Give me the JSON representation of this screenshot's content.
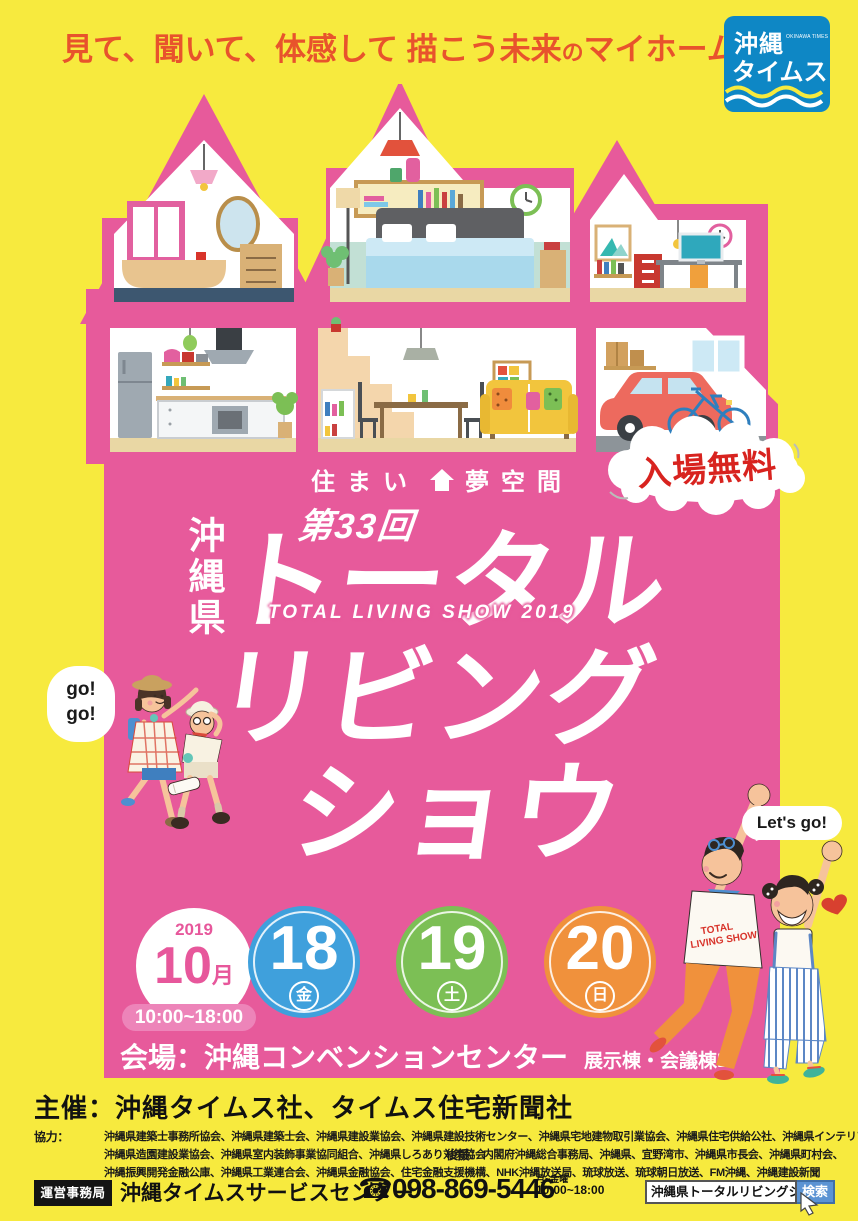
{
  "poster": {
    "headline": {
      "part1": "見て、聞いて、体感して 描こう未来",
      "small": "の",
      "part2": "マイホーム"
    },
    "logo": {
      "name1": "沖縄",
      "name2": "タイムス",
      "sub": "OKINAWA TIMES"
    },
    "tagline": {
      "left": "住まい",
      "right": "夢空間"
    },
    "edition": "第33回",
    "prefecture": "沖縄県",
    "title": {
      "line1": "トータル",
      "line2": "リビング",
      "line3": "ショウ",
      "subtitle": "TOTAL LIVING SHOW 2019"
    },
    "free_admission": "入場無料",
    "bubbles": {
      "go_line1": "go!",
      "go_line2": "go!",
      "lets_go": "Let's go!",
      "tshirt_line1": "TOTAL",
      "tshirt_line2": "LIVING SHOW"
    },
    "schedule": {
      "year": "2019",
      "month": "10",
      "month_unit": "月",
      "hours": "10:00~18:00",
      "days": [
        {
          "num": "18",
          "weekday": "金",
          "color": "#3FA0DC"
        },
        {
          "num": "19",
          "weekday": "土",
          "color": "#7CBF55"
        },
        {
          "num": "20",
          "weekday": "日",
          "color": "#F0913C"
        }
      ],
      "venue": "会場：沖縄コンベンションセンター",
      "venue_note": "展示棟・会議棟B"
    },
    "footer": {
      "organizer": "主催：沖縄タイムス社、タイムス住宅新聞社",
      "cooperation_label": "協力：",
      "cooperation_line1": "沖縄県建築士事務所協会、沖縄県建築士会、沖縄県建設業協会、沖縄県建設技術センター、沖縄県宅地建物取引業協会、沖縄県住宅供給公社、沖縄県インテリアコーディネーター協会、",
      "cooperation_line2": "沖縄県造園建設業協会、沖縄県室内装飾事業協同組合、沖縄県しろあり対策協会",
      "support_label": "後援：",
      "support_line1": "内閣府沖縄総合事務局、沖縄県、宜野湾市、沖縄県市長会、沖縄県町村会、",
      "support_line2": "沖縄振興開発金融公庫、沖縄県工業連合会、沖縄県金融協会、住宅金融支援機構、NHK沖縄放送局、琉球放送、琉球朝日放送、FM沖縄、沖縄建設新聞",
      "office_label": "運営事務局",
      "office_name": "沖縄タイムスサービスセンター",
      "phone": "☎098-869-5446",
      "phone_note1": "月~金曜",
      "phone_note2": "10:00~18:00",
      "search_query": "沖縄県トータルリビングショウ2019",
      "search_button": "検索"
    },
    "colors": {
      "yellow": "#F7EA3E",
      "pink": "#E75A9B",
      "red": "#D8231F",
      "headline_orange": "#E8532C",
      "friday_blue": "#3FA0DC",
      "saturday_green": "#7CBF55",
      "sunday_orange": "#F0913C",
      "logo_blue": "#0E87C5",
      "search_blue": "#5B93D3"
    }
  }
}
